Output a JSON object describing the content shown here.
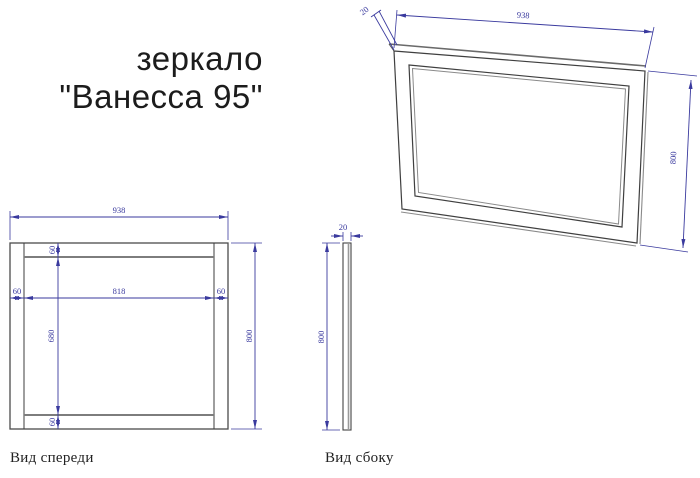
{
  "title": {
    "line1": "зеркало",
    "line2": "\"Ванесса 95\""
  },
  "colors": {
    "dimension": "#3a3a9e",
    "drawing_line_dark": "#3f3f3f",
    "drawing_line_gray": "#7d7d7d",
    "title_text": "#1c1c1c"
  },
  "perspective_view": {
    "dim_thickness": "20",
    "dim_width": "938",
    "dim_height": "800"
  },
  "front_view": {
    "label": "Вид спереди",
    "dim_width": "938",
    "dim_left_margin": "60",
    "dim_inner_width": "818",
    "dim_right_margin": "60",
    "dim_top_margin": "60",
    "dim_inner_height": "680",
    "dim_bottom_margin": "60",
    "dim_height": "800"
  },
  "side_view": {
    "label": "Вид сбоку",
    "dim_thickness": "20",
    "dim_height": "800"
  }
}
